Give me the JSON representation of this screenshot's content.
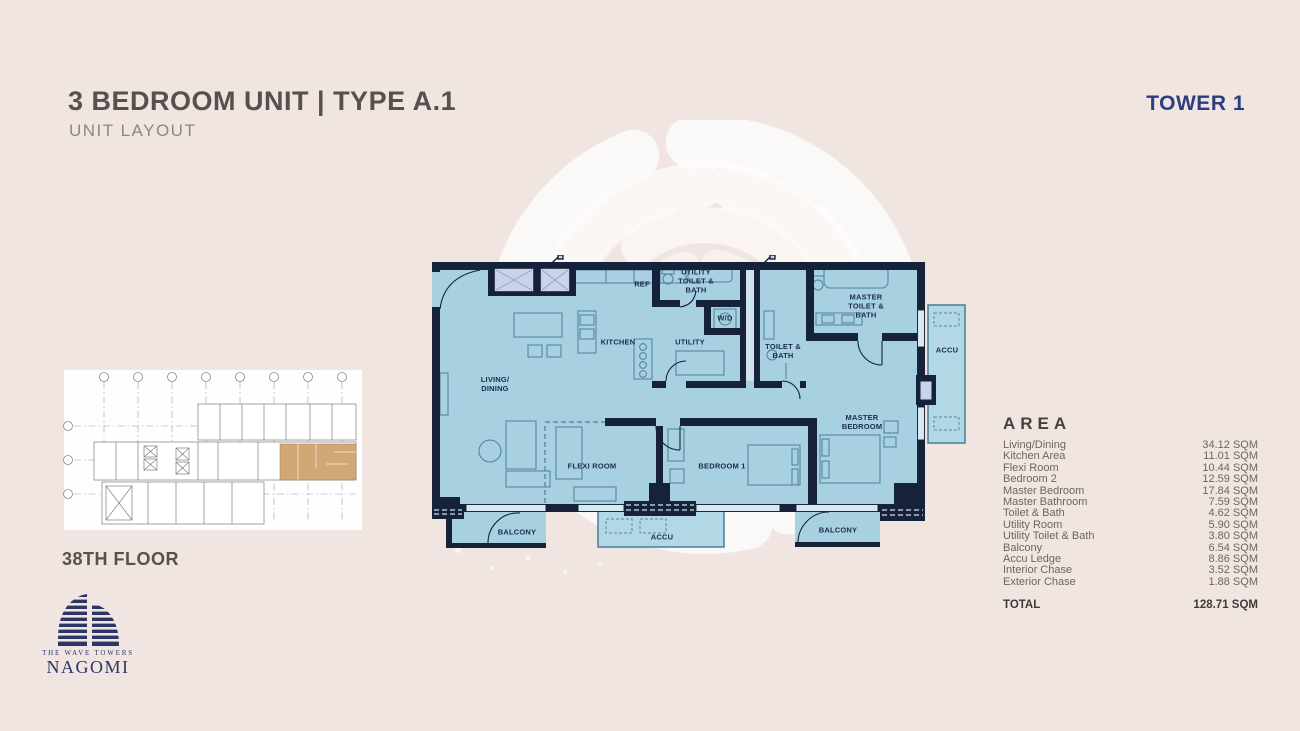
{
  "header": {
    "title": "3 BEDROOM UNIT | TYPE A.1",
    "subtitle": "UNIT LAYOUT",
    "tower_label": "TOWER 1"
  },
  "key_plan": {
    "floor_label": "38TH FLOOR"
  },
  "logo": {
    "tagline": "THE WAVE TOWERS",
    "brand": "NAGOMI"
  },
  "floor_plan": {
    "labels": {
      "living_dining": "LIVING/\nDINING",
      "kitchen": "KITCHEN",
      "ref": "REF",
      "utility_toilet_bath": "UTILITY\nTOILET &\nBATH",
      "wd": "W/D",
      "utility": "UTILITY",
      "toilet_bath": "TOILET &\nBATH",
      "master_toilet_bath": "MASTER\nTOILET &\nBATH",
      "master_bedroom": "MASTER\nBEDROOM",
      "bedroom_1": "BEDROOM 1",
      "flexi_room": "FLEXI ROOM",
      "balcony_left": "BALCONY",
      "accu_bottom": "ACCU",
      "balcony_right": "BALCONY",
      "accu_right": "ACCU"
    }
  },
  "area_table": {
    "title": "AREA",
    "rows": [
      {
        "label": "Living/Dining",
        "value": "34.12 SQM"
      },
      {
        "label": "Kitchen Area",
        "value": "11.01 SQM"
      },
      {
        "label": "Flexi Room",
        "value": "10.44 SQM"
      },
      {
        "label": "Bedroom 2",
        "value": "12.59 SQM"
      },
      {
        "label": "Master Bedroom",
        "value": "17.84 SQM"
      },
      {
        "label": "Master Bathroom",
        "value": "7.59 SQM"
      },
      {
        "label": "Toilet & Bath",
        "value": "4.62 SQM"
      },
      {
        "label": "Utility Room",
        "value": "5.90 SQM"
      },
      {
        "label": "Utility Toilet & Bath",
        "value": "3.80 SQM"
      },
      {
        "label": "Balcony",
        "value": "6.54 SQM"
      },
      {
        "label": "Accu Ledge",
        "value": "8.86 SQM"
      },
      {
        "label": "Interior Chase",
        "value": "3.52 SQM"
      },
      {
        "label": "Exterior Chase",
        "value": "1.88 SQM"
      }
    ],
    "total": {
      "label": "TOTAL",
      "value": "128.71 SQM"
    }
  },
  "colors": {
    "background": "#f0e5e1",
    "plan_fill": "#a7d0e0",
    "wall_navy": "#16213a",
    "accent_navy": "#2c3e7e",
    "logo_navy": "#2c3566",
    "highlight_tan": "#c9995d",
    "swirl_white": "#fdfcfb"
  }
}
